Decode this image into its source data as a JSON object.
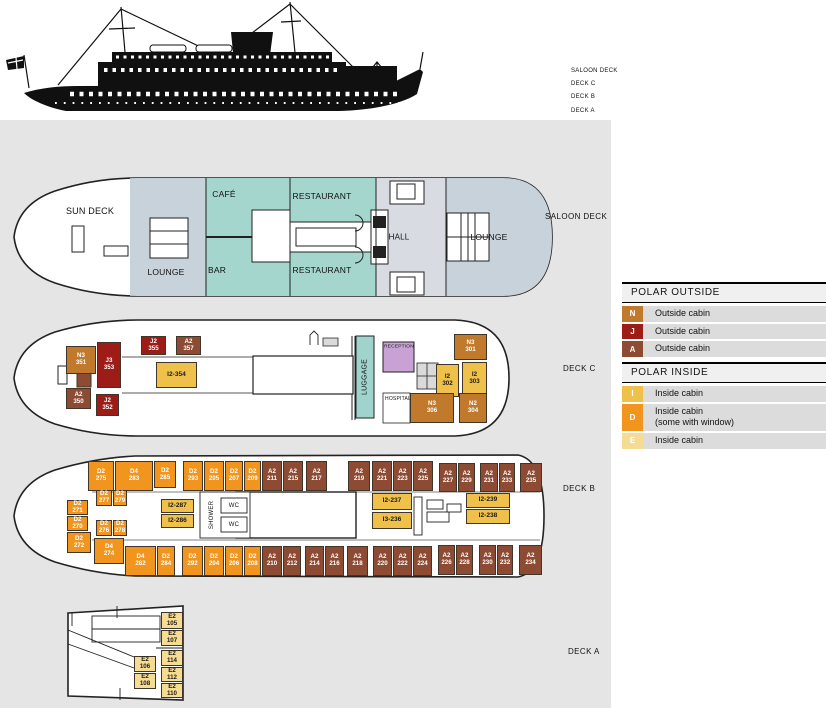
{
  "colors": {
    "N": "#C1792C",
    "J": "#9D1C17",
    "A": "#8E4B33",
    "I": "#EFC14B",
    "D": "#F1951E",
    "E": "#F6DC92"
  },
  "ship_profile": {
    "deck_labels": [
      "SALOON DECK",
      "DECK C",
      "DECK B",
      "DECK A"
    ]
  },
  "legend": {
    "sections": [
      {
        "title": "POLAR OUTSIDE",
        "items": [
          {
            "code": "N",
            "label": "Outside cabin"
          },
          {
            "code": "J",
            "label": "Outside cabin"
          },
          {
            "code": "A",
            "label": "Outside cabin"
          }
        ]
      },
      {
        "title": "POLAR INSIDE",
        "items": [
          {
            "code": "I",
            "label": "Inside cabin"
          },
          {
            "code": "D",
            "label": "Inside cabin",
            "label2": "(some with window)"
          },
          {
            "code": "E",
            "label": "Inside cabin"
          }
        ]
      }
    ]
  },
  "decks": [
    {
      "id": "saloon",
      "label": "SALOON DECK",
      "lx": 545,
      "ly": 212,
      "rooms": [
        {
          "text": "SUN DECK",
          "x": 90,
          "y": 211,
          "fs": 9
        },
        {
          "text": "LOUNGE",
          "x": 166,
          "y": 272,
          "fs": 8.5
        },
        {
          "text": "CAFÉ",
          "x": 224,
          "y": 194,
          "fs": 8.5
        },
        {
          "text": "BAR",
          "x": 217,
          "y": 270,
          "fs": 8.5
        },
        {
          "text": "RESTAURANT",
          "x": 322,
          "y": 196,
          "fs": 8.5
        },
        {
          "text": "RESTAURANT",
          "x": 322,
          "y": 270,
          "fs": 8.5
        },
        {
          "text": "HALL",
          "x": 399,
          "y": 237,
          "fs": 8
        },
        {
          "text": "LOUNGE",
          "x": 489,
          "y": 237,
          "fs": 8.5
        }
      ],
      "cabins": []
    },
    {
      "id": "c",
      "label": "DECK C",
      "lx": 563,
      "ly": 364,
      "rooms": [
        {
          "text": "LUGGAGE",
          "x": 365,
          "y": 377,
          "fs": 7,
          "rot": 1
        },
        {
          "text": "RECEPTION",
          "x": 399,
          "y": 347,
          "fs": 4.8
        },
        {
          "text": "HOSPITAL",
          "x": 398,
          "y": 399,
          "fs": 5
        }
      ],
      "cabins": [
        {
          "t": "J",
          "a": "J2",
          "b": "355",
          "x": 141,
          "y": 336,
          "w": 25,
          "h": 19
        },
        {
          "t": "A",
          "a": "A2",
          "b": "357",
          "x": 176,
          "y": 336,
          "w": 25,
          "h": 19
        },
        {
          "t": "N",
          "a": "N3",
          "b": "351",
          "x": 66,
          "y": 346,
          "w": 30,
          "h": 28
        },
        {
          "t": "J",
          "a": "J3",
          "b": "353",
          "x": 97,
          "y": 342,
          "w": 24,
          "h": 46
        },
        {
          "t": "I",
          "a": "I2-354",
          "x": 156,
          "y": 362,
          "w": 41,
          "h": 26
        },
        {
          "t": "A",
          "a": "A2",
          "b": "350",
          "x": 66,
          "y": 388,
          "w": 25,
          "h": 21
        },
        {
          "t": "J",
          "a": "J2",
          "b": "352",
          "x": 96,
          "y": 394,
          "w": 23,
          "h": 22
        },
        {
          "t": "N",
          "a": "N3",
          "b": "301",
          "x": 454,
          "y": 334,
          "w": 33,
          "h": 26
        },
        {
          "t": "I",
          "a": "I2",
          "b": "302",
          "x": 436,
          "y": 364,
          "w": 23,
          "h": 33
        },
        {
          "t": "I",
          "a": "I2",
          "b": "303",
          "x": 462,
          "y": 362,
          "w": 25,
          "h": 33
        },
        {
          "t": "N",
          "a": "N3",
          "b": "306",
          "x": 410,
          "y": 393,
          "w": 44,
          "h": 30
        },
        {
          "t": "N",
          "a": "N2",
          "b": "304",
          "x": 459,
          "y": 393,
          "w": 28,
          "h": 30
        }
      ]
    },
    {
      "id": "b",
      "label": "DECK B",
      "lx": 563,
      "ly": 484,
      "rooms": [
        {
          "text": "SHOWER",
          "x": 212,
          "y": 515,
          "fs": 6,
          "rot": 1
        },
        {
          "text": "WC",
          "x": 234,
          "y": 506,
          "fs": 6
        },
        {
          "text": "WC",
          "x": 234,
          "y": 525,
          "fs": 6
        }
      ],
      "cabins": [
        {
          "t": "D",
          "a": "D2",
          "b": "275",
          "x": 88,
          "y": 461,
          "w": 26,
          "h": 30
        },
        {
          "t": "D",
          "a": "D4",
          "b": "283",
          "x": 115,
          "y": 461,
          "w": 38,
          "h": 30
        },
        {
          "t": "D",
          "a": "D2",
          "b": "285",
          "x": 154,
          "y": 461,
          "w": 22,
          "h": 27
        },
        {
          "t": "D",
          "a": "D2",
          "b": "293",
          "x": 183,
          "y": 461,
          "w": 20,
          "h": 30
        },
        {
          "t": "D",
          "a": "D2",
          "b": "205",
          "x": 204,
          "y": 461,
          "w": 20,
          "h": 30
        },
        {
          "t": "D",
          "a": "D2",
          "b": "207",
          "x": 225,
          "y": 461,
          "w": 18,
          "h": 30
        },
        {
          "t": "D",
          "a": "D2",
          "b": "209",
          "x": 244,
          "y": 461,
          "w": 17,
          "h": 30
        },
        {
          "t": "A",
          "a": "A2",
          "b": "211",
          "x": 262,
          "y": 461,
          "w": 20,
          "h": 30
        },
        {
          "t": "A",
          "a": "A2",
          "b": "215",
          "x": 283,
          "y": 461,
          "w": 20,
          "h": 30
        },
        {
          "t": "A",
          "a": "A2",
          "b": "217",
          "x": 306,
          "y": 461,
          "w": 21,
          "h": 30
        },
        {
          "t": "A",
          "a": "A2",
          "b": "219",
          "x": 348,
          "y": 461,
          "w": 22,
          "h": 30
        },
        {
          "t": "A",
          "a": "A2",
          "b": "221",
          "x": 372,
          "y": 461,
          "w": 20,
          "h": 30
        },
        {
          "t": "A",
          "a": "A2",
          "b": "223",
          "x": 393,
          "y": 461,
          "w": 19,
          "h": 30
        },
        {
          "t": "A",
          "a": "A2",
          "b": "225",
          "x": 413,
          "y": 461,
          "w": 20,
          "h": 30
        },
        {
          "t": "A",
          "a": "A2",
          "b": "227",
          "x": 439,
          "y": 463,
          "w": 18,
          "h": 29
        },
        {
          "t": "A",
          "a": "A2",
          "b": "229",
          "x": 458,
          "y": 463,
          "w": 17,
          "h": 29
        },
        {
          "t": "A",
          "a": "A2",
          "b": "231",
          "x": 480,
          "y": 463,
          "w": 18,
          "h": 29
        },
        {
          "t": "A",
          "a": "A2",
          "b": "233",
          "x": 499,
          "y": 463,
          "w": 16,
          "h": 29
        },
        {
          "t": "A",
          "a": "A2",
          "b": "235",
          "x": 520,
          "y": 463,
          "w": 22,
          "h": 29
        },
        {
          "t": "D",
          "a": "D2",
          "b": "271",
          "x": 67,
          "y": 500,
          "w": 21,
          "h": 15
        },
        {
          "t": "D",
          "a": "D2",
          "b": "270",
          "x": 67,
          "y": 516,
          "w": 21,
          "h": 15
        },
        {
          "t": "D",
          "a": "D2",
          "b": "272",
          "x": 67,
          "y": 532,
          "w": 24,
          "h": 21
        },
        {
          "t": "D",
          "a": "D2",
          "b": "277",
          "x": 96,
          "y": 490,
          "w": 16,
          "h": 16
        },
        {
          "t": "D",
          "a": "D2",
          "b": "279",
          "x": 113,
          "y": 490,
          "w": 14,
          "h": 16
        },
        {
          "t": "D",
          "a": "D2",
          "b": "276",
          "x": 96,
          "y": 520,
          "w": 16,
          "h": 16
        },
        {
          "t": "D",
          "a": "D2",
          "b": "278",
          "x": 113,
          "y": 520,
          "w": 14,
          "h": 16
        },
        {
          "t": "I",
          "a": "I2-287",
          "x": 161,
          "y": 499,
          "w": 33,
          "h": 14
        },
        {
          "t": "I",
          "a": "I2-286",
          "x": 161,
          "y": 514,
          "w": 33,
          "h": 14
        },
        {
          "t": "I",
          "a": "I2-237",
          "x": 372,
          "y": 493,
          "w": 40,
          "h": 17
        },
        {
          "t": "I",
          "a": "I3-236",
          "x": 372,
          "y": 512,
          "w": 40,
          "h": 17
        },
        {
          "t": "I",
          "a": "I2-239",
          "x": 466,
          "y": 493,
          "w": 44,
          "h": 15
        },
        {
          "t": "I",
          "a": "I2-238",
          "x": 466,
          "y": 509,
          "w": 44,
          "h": 15
        },
        {
          "t": "D",
          "a": "D4",
          "b": "274",
          "x": 94,
          "y": 538,
          "w": 30,
          "h": 26
        },
        {
          "t": "D",
          "a": "D4",
          "b": "282",
          "x": 125,
          "y": 546,
          "w": 31,
          "h": 30
        },
        {
          "t": "D",
          "a": "D2",
          "b": "284",
          "x": 157,
          "y": 546,
          "w": 18,
          "h": 30
        },
        {
          "t": "D",
          "a": "D2",
          "b": "292",
          "x": 182,
          "y": 546,
          "w": 21,
          "h": 30
        },
        {
          "t": "D",
          "a": "D2",
          "b": "204",
          "x": 204,
          "y": 546,
          "w": 20,
          "h": 30
        },
        {
          "t": "D",
          "a": "D2",
          "b": "206",
          "x": 225,
          "y": 546,
          "w": 18,
          "h": 30
        },
        {
          "t": "D",
          "a": "D2",
          "b": "208",
          "x": 244,
          "y": 546,
          "w": 17,
          "h": 30
        },
        {
          "t": "A",
          "a": "A2",
          "b": "210",
          "x": 262,
          "y": 546,
          "w": 20,
          "h": 30
        },
        {
          "t": "A",
          "a": "A2",
          "b": "212",
          "x": 283,
          "y": 546,
          "w": 18,
          "h": 30
        },
        {
          "t": "A",
          "a": "A2",
          "b": "214",
          "x": 305,
          "y": 546,
          "w": 19,
          "h": 30
        },
        {
          "t": "A",
          "a": "A2",
          "b": "216",
          "x": 325,
          "y": 546,
          "w": 19,
          "h": 30
        },
        {
          "t": "A",
          "a": "A2",
          "b": "218",
          "x": 347,
          "y": 546,
          "w": 21,
          "h": 30
        },
        {
          "t": "A",
          "a": "A2",
          "b": "220",
          "x": 373,
          "y": 546,
          "w": 19,
          "h": 30
        },
        {
          "t": "A",
          "a": "A2",
          "b": "222",
          "x": 393,
          "y": 546,
          "w": 19,
          "h": 30
        },
        {
          "t": "A",
          "a": "A2",
          "b": "224",
          "x": 413,
          "y": 546,
          "w": 19,
          "h": 30
        },
        {
          "t": "A",
          "a": "A2",
          "b": "226",
          "x": 438,
          "y": 545,
          "w": 17,
          "h": 30
        },
        {
          "t": "A",
          "a": "A2",
          "b": "228",
          "x": 456,
          "y": 545,
          "w": 17,
          "h": 30
        },
        {
          "t": "A",
          "a": "A2",
          "b": "230",
          "x": 479,
          "y": 545,
          "w": 17,
          "h": 30
        },
        {
          "t": "A",
          "a": "A2",
          "b": "232",
          "x": 497,
          "y": 545,
          "w": 16,
          "h": 30
        },
        {
          "t": "A",
          "a": "A2",
          "b": "234",
          "x": 519,
          "y": 545,
          "w": 23,
          "h": 30
        }
      ]
    },
    {
      "id": "a",
      "label": "DECK A",
      "lx": 568,
      "ly": 647,
      "rooms": [],
      "cabins": [
        {
          "t": "E",
          "a": "E2",
          "b": "105",
          "x": 161,
          "y": 612,
          "w": 22,
          "h": 17
        },
        {
          "t": "E",
          "a": "E2",
          "b": "107",
          "x": 161,
          "y": 630,
          "w": 22,
          "h": 16
        },
        {
          "t": "E",
          "a": "E2",
          "b": "114",
          "x": 161,
          "y": 650,
          "w": 22,
          "h": 16
        },
        {
          "t": "E",
          "a": "E2",
          "b": "112",
          "x": 161,
          "y": 667,
          "w": 22,
          "h": 15
        },
        {
          "t": "E",
          "a": "E2",
          "b": "110",
          "x": 161,
          "y": 683,
          "w": 22,
          "h": 15
        },
        {
          "t": "E",
          "a": "E2",
          "b": "106",
          "x": 134,
          "y": 656,
          "w": 22,
          "h": 16
        },
        {
          "t": "E",
          "a": "E2",
          "b": "108",
          "x": 134,
          "y": 673,
          "w": 22,
          "h": 16
        }
      ]
    }
  ]
}
